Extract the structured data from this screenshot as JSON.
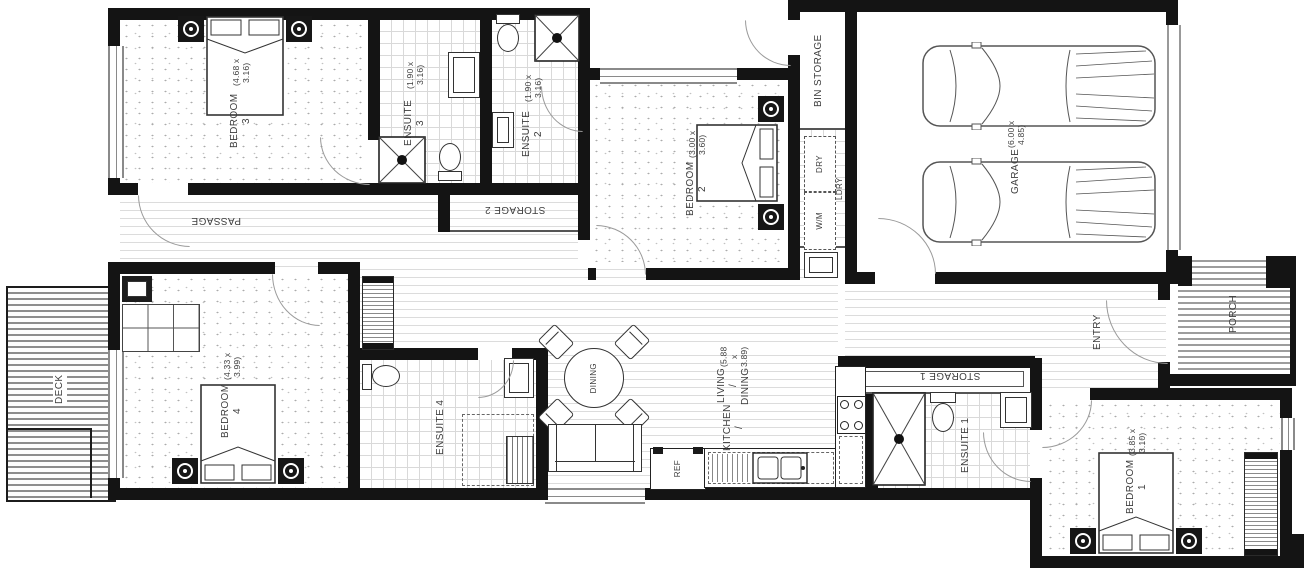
{
  "plan_title": "Residential floor plan",
  "rooms": {
    "bedroom3": {
      "name": "BEDROOM 3",
      "dims": "(4.68 x 3.16)"
    },
    "ensuite3": {
      "name": "ENSUITE 3",
      "dims": "(1.90 x 3.16)"
    },
    "ensuite2": {
      "name": "ENSUITE 2",
      "dims": "(1.90 x 3.16)"
    },
    "storage2": {
      "name": "STORAGE 2"
    },
    "passage": {
      "name": "PASSAGE"
    },
    "bedroom2": {
      "name": "BEDROOM 2",
      "dims": "(3.00 x 3.60)"
    },
    "bin_storage": {
      "name": "BIN STORAGE"
    },
    "laundry": {
      "name": "LDRY",
      "washer": "W/M",
      "dryer": "DRY"
    },
    "garage": {
      "name": "GARAGE",
      "dims": "(6.00 x 4.85)"
    },
    "entry": {
      "name": "ENTRY"
    },
    "porch": {
      "name": "PORCH"
    },
    "bedroom1": {
      "name": "BEDROOM 1",
      "dims": "(3.85 x 3.10)"
    },
    "ensuite1": {
      "name": "ENSUITE 1"
    },
    "storage1": {
      "name": "STORAGE 1"
    },
    "kitchen_living": {
      "name": "KITCHEN /",
      "name2": "LIVING / DINING",
      "dims": "(5.88 x 3.89)"
    },
    "dining": {
      "name": "DINING"
    },
    "fridge": {
      "name": "REF"
    },
    "ensuite4": {
      "name": "ENSUITE 4"
    },
    "bedroom4": {
      "name": "BEDROOM 4",
      "dims": "(4.33 x 3.99)"
    },
    "deck": {
      "name": "DECK"
    }
  },
  "fixtures": [
    "double-bed",
    "bedside-table",
    "toilet",
    "shower",
    "vanity-basin",
    "sofa",
    "round-dining-table",
    "dining-chair",
    "refrigerator",
    "cooktop",
    "kitchen-sink",
    "car",
    "washing-machine",
    "dryer",
    "laundry-tub",
    "wardrobe",
    "cabinet"
  ],
  "colors": {
    "wall": "#141414",
    "line": "#444444",
    "floor_line": "#d8d8d8",
    "background": "#ffffff"
  }
}
